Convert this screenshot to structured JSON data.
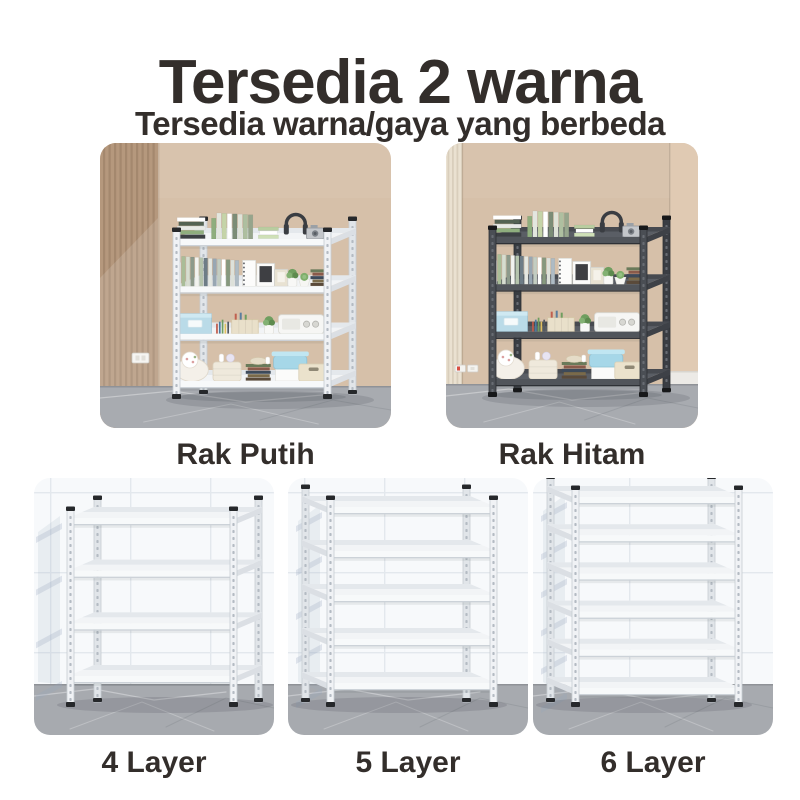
{
  "header": {
    "title": "Tersedia 2 warna",
    "subtitle": "Tersedia warna/gaya yang berbeda"
  },
  "color_section": {
    "items": [
      {
        "label": "Rak Putih",
        "color_name": "white",
        "layers": 4
      },
      {
        "label": "Rak Hitam",
        "color_name": "black",
        "layers": 4
      }
    ]
  },
  "layer_section": {
    "items": [
      {
        "label": "4 Layer",
        "layers": 4,
        "color_name": "white"
      },
      {
        "label": "5 Layer",
        "layers": 5,
        "color_name": "white"
      },
      {
        "label": "6 Layer",
        "layers": 6,
        "color_name": "white"
      }
    ]
  },
  "colors": {
    "text": "#332e2b",
    "page_background": "#ffffff",
    "room_wall": "#d6c0a9",
    "room_slat_dark": "#b5987d",
    "room_slat_light": "#eae1d1",
    "room_corner_wall": "#e0cab3",
    "room_floor": "#a8abb0",
    "tile_wall": "#f7f9fb",
    "tile_grout": "#e3e8ed",
    "tile_floor": "#a7aaaf",
    "rack_white": "#f0f2f5",
    "rack_black": "#4a4e54",
    "cap_black": "#26282b"
  }
}
